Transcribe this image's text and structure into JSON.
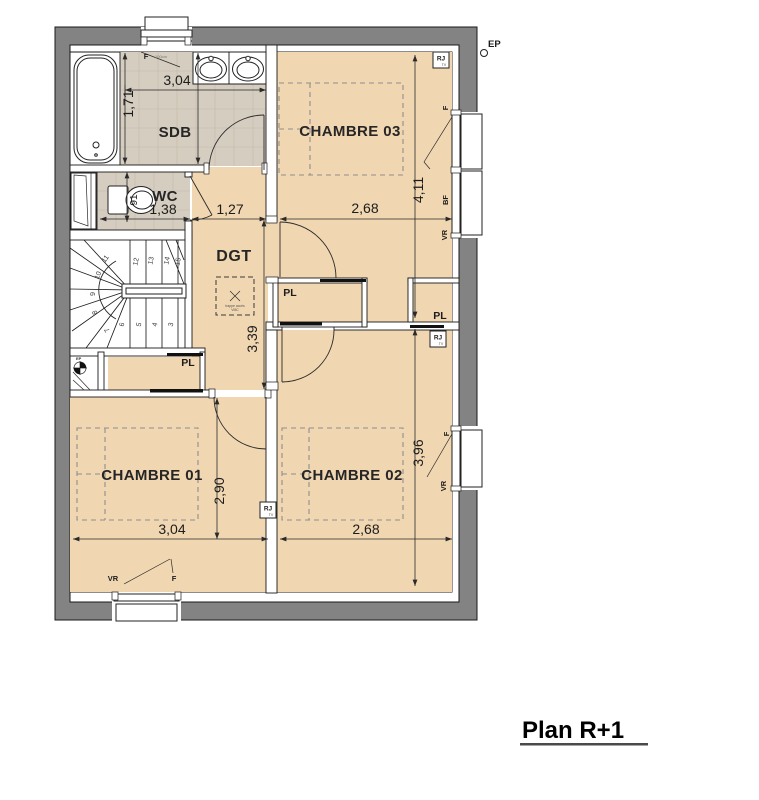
{
  "title": {
    "text": "Plan R+1"
  },
  "rooms": {
    "sdb": "SDB",
    "wc": "WC",
    "dgt": "DGT",
    "chambre1": "CHAMBRE 01",
    "chambre2": "CHAMBRE 02",
    "chambre3": "CHAMBRE 03"
  },
  "closets": {
    "pl": "PL"
  },
  "dimensions": {
    "sdb_width": "3,04",
    "sdb_depth": "1,71",
    "wc_width": "1,38",
    "hall_width": "1,27",
    "ch3_width": "2,68",
    "ch3_depth": "4,11",
    "dgt_depth": "3,39",
    "ch1_depth": "2,90",
    "ch1_width": "3,04",
    "ch2_width": "2,68",
    "ch2_depth": "3,96",
    "wc_toilet": "91"
  },
  "openings": {
    "window": "F",
    "low_window": "BF",
    "shutter": "VR",
    "sdb_window_note": "100cm"
  },
  "tech": {
    "rj": "RJ",
    "tv": "TV",
    "ep": "EP",
    "vmc_line1": "trappe accès",
    "vmc_line2": "VMC"
  },
  "stairs": {
    "steps": [
      "3",
      "4",
      "5",
      "6",
      "7",
      "8",
      "9",
      "10",
      "11",
      "12",
      "13",
      "14",
      "15"
    ]
  },
  "colors": {
    "wall_gray": "#838383",
    "room_beige": "#f0d6b1",
    "tile_khaki": "#d5cdc0"
  }
}
